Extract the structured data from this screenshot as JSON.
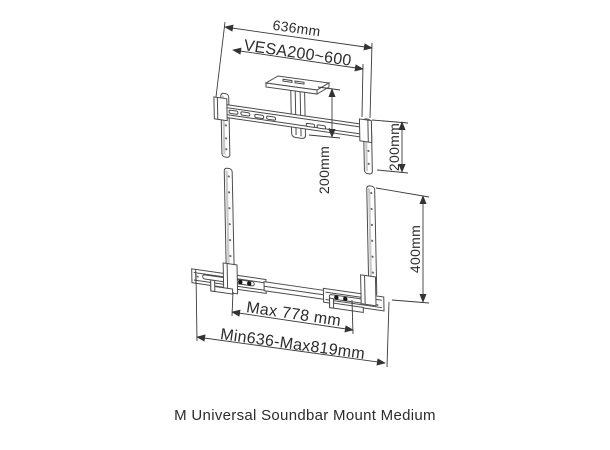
{
  "diagram": {
    "dimensions": {
      "top_width": "636mm",
      "vesa_range": "VESA200~600",
      "column_length": "200mm",
      "right_upper": "200mm",
      "right_lower": "400mm",
      "max_width": "Max 778 mm",
      "min_max_width": "Min636-Max819mm"
    },
    "colors": {
      "line": "#4a4a4a",
      "dimension_line": "#3a3a3a",
      "text": "#2c2c2c",
      "background": "#ffffff"
    }
  },
  "caption": "M Universal Soundbar Mount Medium"
}
